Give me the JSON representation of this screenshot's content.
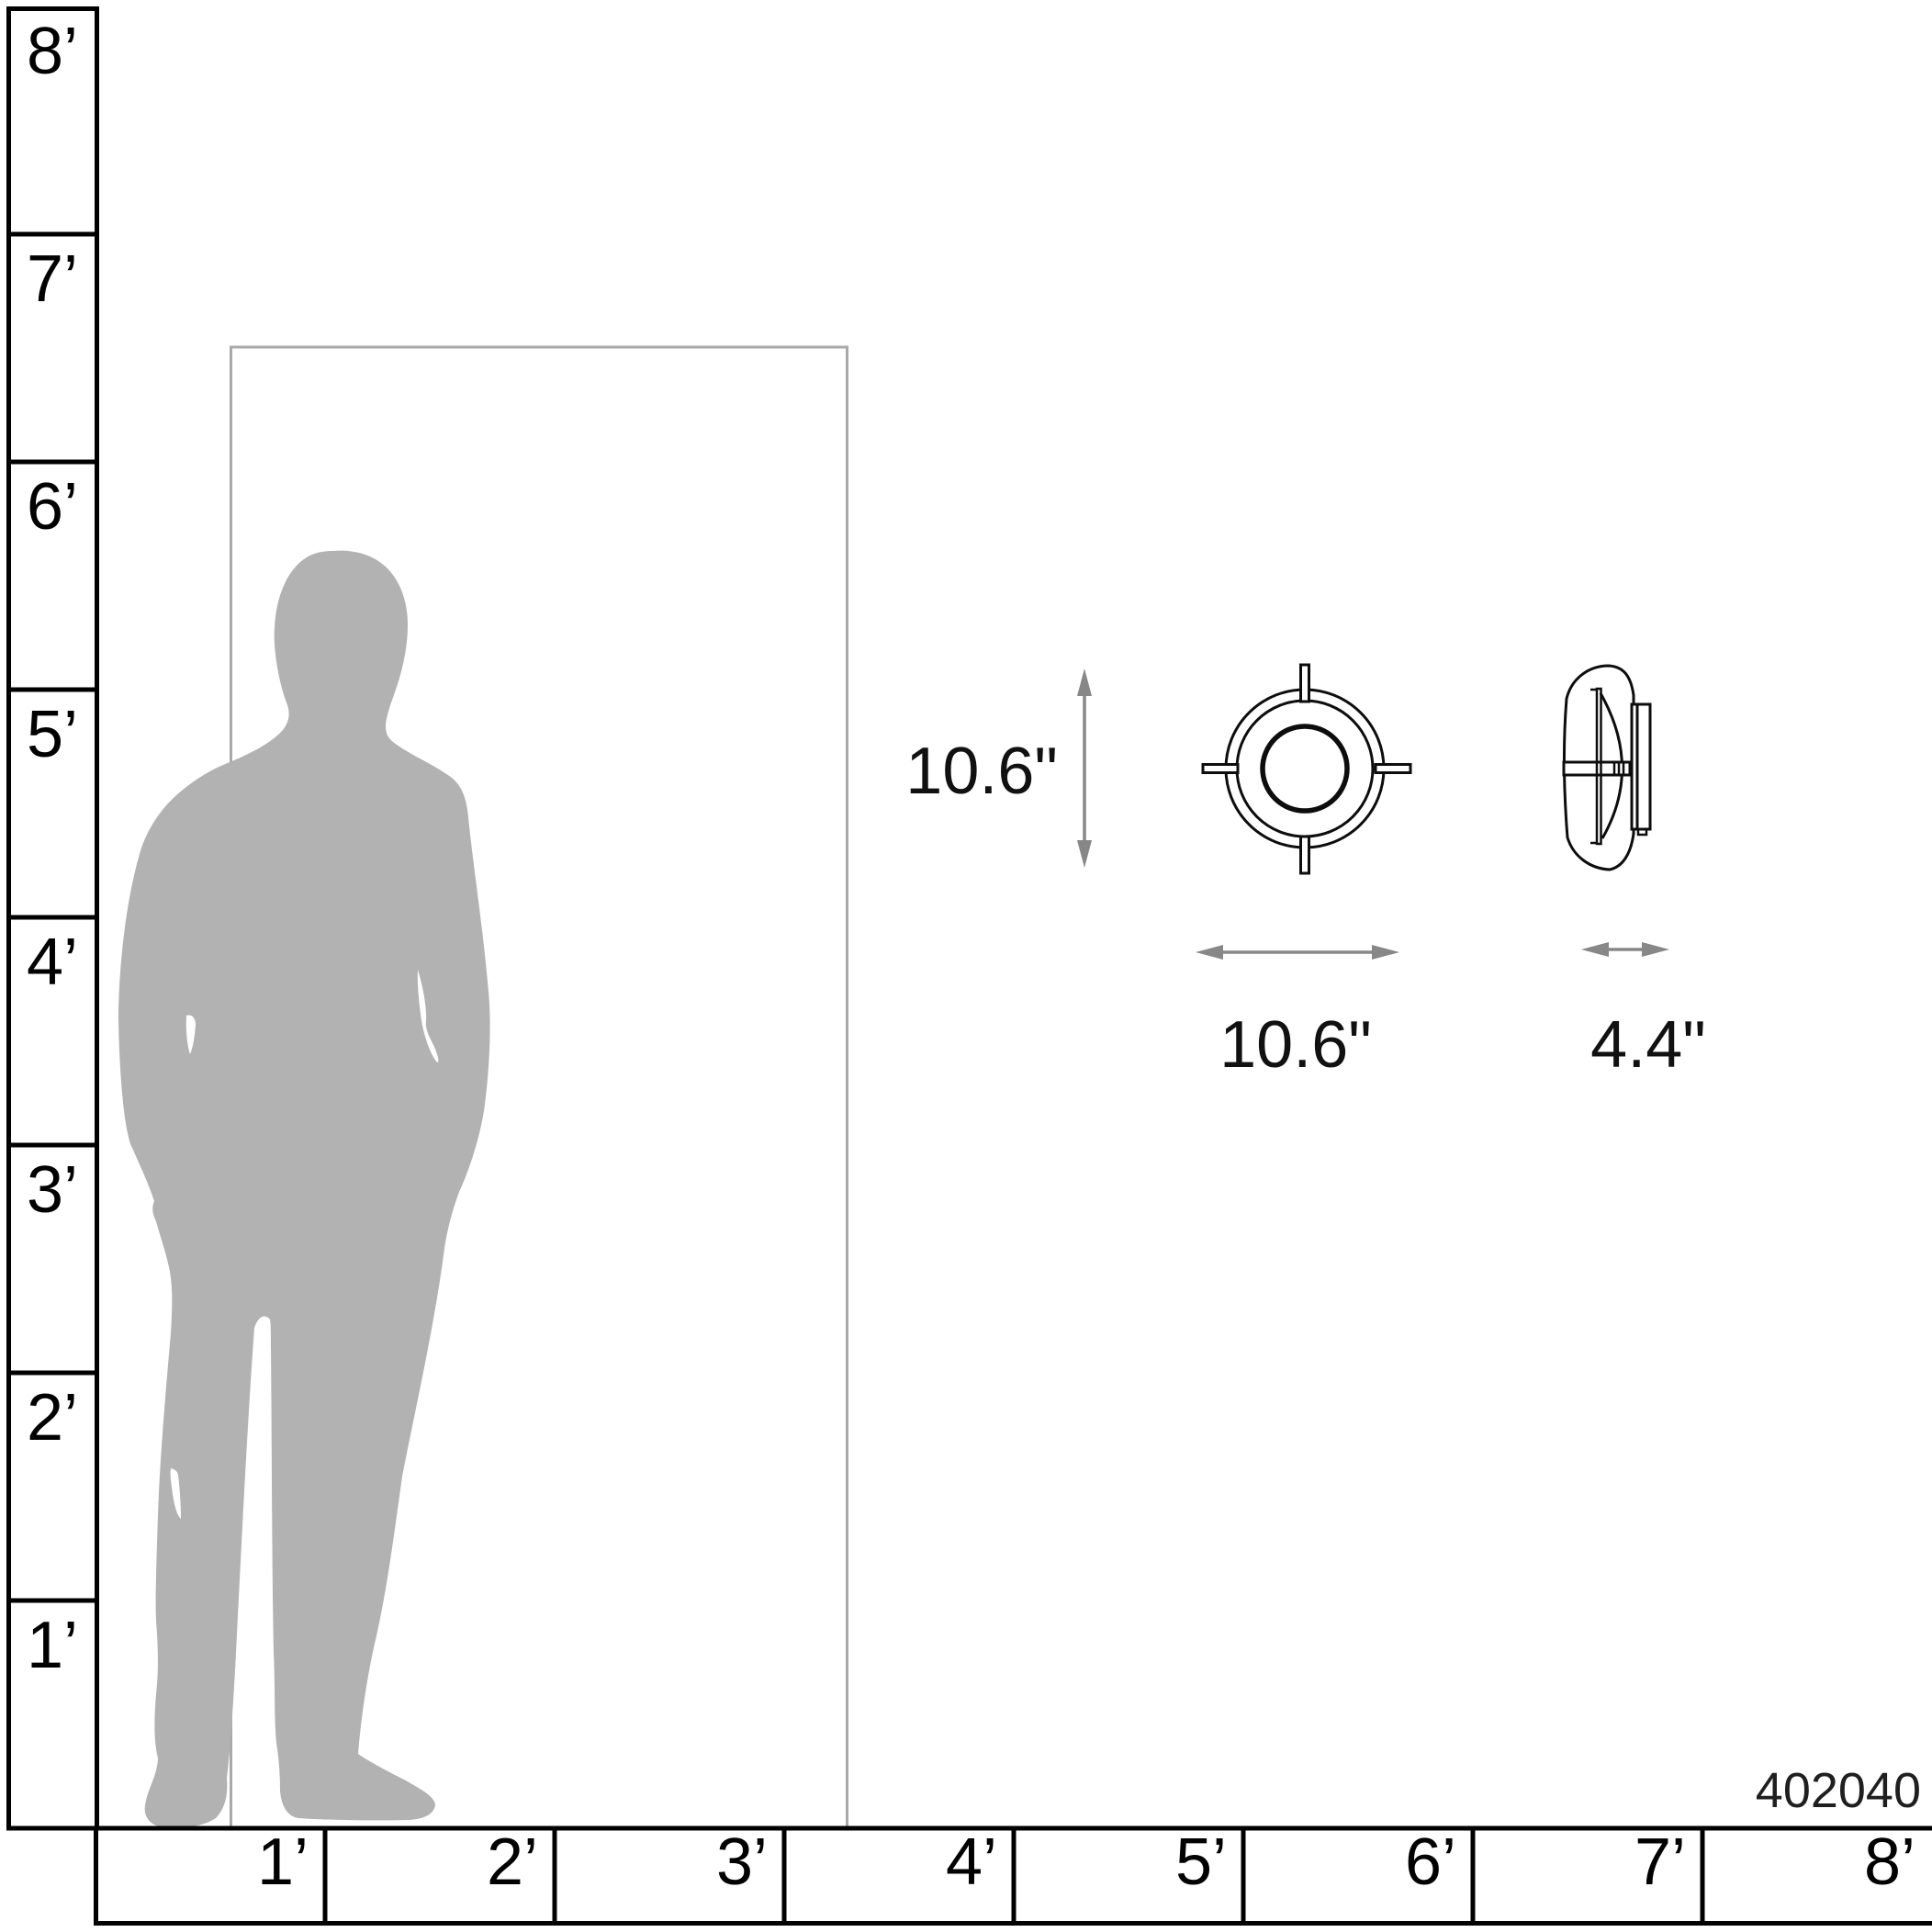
{
  "rulers": {
    "vertical_labels": [
      "8’",
      "7’",
      "6’",
      "5’",
      "4’",
      "3’",
      "2’",
      "1’"
    ],
    "horizontal_labels": [
      "1’",
      "2’",
      "3’",
      "4’",
      "5’",
      "6’",
      "7’",
      "8’"
    ]
  },
  "dimensions": {
    "height": "10.6\"",
    "width": "10.6\"",
    "depth": "4.4\""
  },
  "product_code": "402040",
  "icons": {
    "man_silhouette": "standing-man-silhouette",
    "door": "door-outline",
    "fixture_front": "flush-mount-light-front-view",
    "fixture_side": "flush-mount-light-side-view",
    "arrows": "double-headed-dimension-arrow"
  },
  "colors": {
    "silhouette": "#b2b2b2",
    "door_outline": "#a9a9a9",
    "dimension_arrow": "#878787",
    "ink": "#000000",
    "background": "#ffffff"
  }
}
